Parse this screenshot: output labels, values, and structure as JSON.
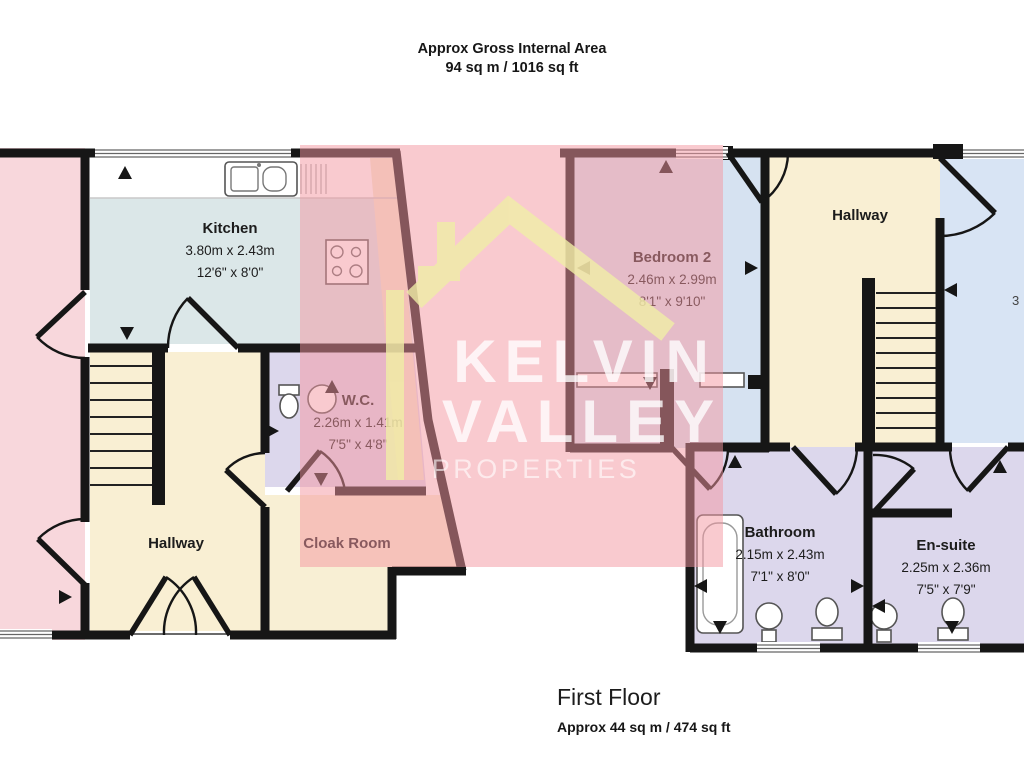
{
  "header": {
    "line1": "Approx Gross Internal Area",
    "line2": "94 sq m / 1016 sq ft"
  },
  "footer": {
    "title": "First Floor",
    "area": "Approx 44 sq m / 474 sq ft"
  },
  "watermark": {
    "brand_line1": "KELVIN",
    "brand_line2": "VALLEY",
    "brand_line3": "PROPERTIES",
    "logo_icon": "house-roof-icon",
    "roof_color": "#f0eda6",
    "overlay_color": "rgba(243,150,160,0.5)",
    "text_color": "rgba(255,255,255,0.75)"
  },
  "rooms": {
    "kitchen": {
      "name": "Kitchen",
      "dim_m": "3.80m x 2.43m",
      "dim_ft": "12'6\" x 8'0\""
    },
    "wc": {
      "name": "W.C.",
      "dim_m": "2.26m x 1.41m",
      "dim_ft": "7'5\" x 4'8\""
    },
    "hallway_left": {
      "name": "Hallway"
    },
    "cloak_room": {
      "name": "Cloak Room"
    },
    "bedroom2": {
      "name": "Bedroom 2",
      "dim_m": "2.46m x 2.99m",
      "dim_ft": "8'1\" x 9'10\""
    },
    "hallway_right": {
      "name": "Hallway"
    },
    "bathroom": {
      "name": "Bathroom",
      "dim_m": "2.15m x 2.43m",
      "dim_ft": "7'1\" x 8'0\""
    },
    "ensuite": {
      "name": "En-suite",
      "dim_m": "2.25m x 2.36m",
      "dim_ft": "7'5\" x 7'9\""
    },
    "right_room_partial": {
      "partial_text": "3"
    }
  },
  "colors": {
    "wall": "#161616",
    "kitchen_floor": "#dbe7e8",
    "hallway_floor": "#f9efd3",
    "pink_room": "#f8d7dc",
    "bedroom_floor": "#d6e2f1",
    "bath_floor": "#dcd7ec",
    "counter": "#f4ead1"
  }
}
